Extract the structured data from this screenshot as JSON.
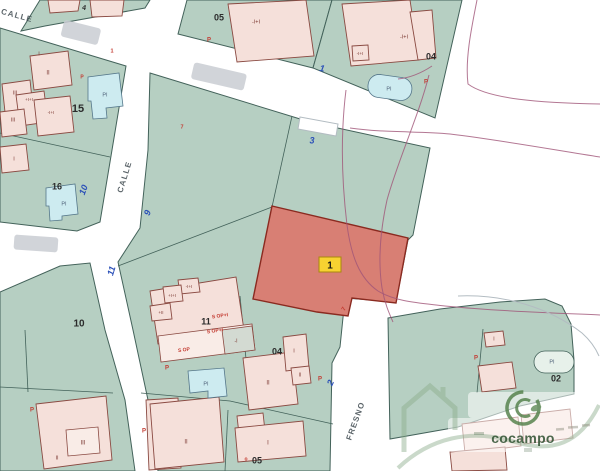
{
  "colors": {
    "green": "#b6cfc2",
    "line": "#43625a",
    "pink": "#f5e0da",
    "pinkline": "#8a4a42",
    "pool": "#cdebf0",
    "poolline": "#55778a",
    "red": "#d87f74",
    "redline": "#8a2a20",
    "yellow": "#f7d231",
    "blue": "#2b50b8",
    "purple": "#a05578",
    "casing": "#b3bcc2",
    "brand": "#4e7d45"
  },
  "highlight": {
    "parcel_label": "1"
  },
  "watermark": {
    "brand": "cocampo"
  },
  "labels": [
    {
      "id": "calle-top",
      "t": "CALLE",
      "x": 17,
      "y": 16,
      "r": 15,
      "c": "street"
    },
    {
      "id": "calle-west",
      "t": "CALLE",
      "x": 125,
      "y": 177,
      "r": -73,
      "c": "street"
    },
    {
      "id": "fresno",
      "t": "FRESNO",
      "x": 356,
      "y": 421,
      "r": -70,
      "c": "street"
    },
    {
      "id": "parcel-05-top",
      "t": "05",
      "x": 219,
      "y": 18,
      "c": "pnum"
    },
    {
      "id": "parcel-04-top",
      "t": "04",
      "x": 431,
      "y": 57,
      "c": "pnum"
    },
    {
      "id": "parcel-15",
      "t": "15",
      "x": 78,
      "y": 109,
      "c": "pnum",
      "s": 11
    },
    {
      "id": "parcel-16",
      "t": "16",
      "x": 57,
      "y": 187,
      "c": "pnum"
    },
    {
      "id": "parcel-10",
      "t": "10",
      "x": 79,
      "y": 324,
      "c": "pnum",
      "s": 10
    },
    {
      "id": "parcel-11",
      "t": "11",
      "x": 206,
      "y": 322,
      "c": "pnum"
    },
    {
      "id": "parcel-04-mid",
      "t": "04",
      "x": 277,
      "y": 352,
      "c": "pnum"
    },
    {
      "id": "parcel-05-bottom",
      "t": "05",
      "x": 257,
      "y": 461,
      "c": "pnum"
    },
    {
      "id": "parcel-02",
      "t": "02",
      "x": 556,
      "y": 379,
      "c": "pnum"
    },
    {
      "id": "housenum-4",
      "t": "4",
      "x": 84,
      "y": 8,
      "r": 12,
      "c": "pnum",
      "s": 7
    },
    {
      "id": "housenum-1",
      "t": "1",
      "x": 322,
      "y": 69,
      "r": 10,
      "c": "house"
    },
    {
      "id": "housenum-3",
      "t": "3",
      "x": 312,
      "y": 141,
      "c": "house"
    },
    {
      "id": "housenum-9",
      "t": "9",
      "x": 148,
      "y": 213,
      "r": -70,
      "c": "house"
    },
    {
      "id": "housenum-10",
      "t": "10",
      "x": 84,
      "y": 190,
      "r": -70,
      "c": "house"
    },
    {
      "id": "housenum-11",
      "t": "11",
      "x": 112,
      "y": 271,
      "r": -73,
      "c": "house"
    },
    {
      "id": "housenum-2",
      "t": "2",
      "x": 331,
      "y": 383,
      "r": -65,
      "c": "house"
    },
    {
      "id": "bldg-15-ii",
      "t": "II",
      "x": 48,
      "y": 73,
      "c": "bldg"
    },
    {
      "id": "bldg-15-iii-a",
      "t": "III",
      "x": 15,
      "y": 93,
      "c": "bldg",
      "s": 5.5
    },
    {
      "id": "bldg-15-plus",
      "t": "+I+I",
      "x": 29,
      "y": 100,
      "c": "bldg",
      "s": 4.5
    },
    {
      "id": "bldg-15-minus",
      "t": "-I+I",
      "x": 51,
      "y": 113,
      "c": "bldg",
      "s": 4.5
    },
    {
      "id": "bldg-15-iii-b",
      "t": "III",
      "x": 13,
      "y": 120,
      "c": "bldg",
      "s": 5.5
    },
    {
      "id": "bldg-15-i",
      "t": "I",
      "x": 39,
      "y": 54,
      "c": "bldg",
      "s": 5.5
    },
    {
      "id": "bldg-16-i",
      "t": "I",
      "x": 14,
      "y": 159,
      "c": "bldg",
      "s": 5.5
    },
    {
      "id": "bldg-05top",
      "t": "-I+I",
      "x": 256,
      "y": 22,
      "c": "bldg",
      "s": 5.5
    },
    {
      "id": "bldg-04top-a",
      "t": "-I+I",
      "x": 404,
      "y": 37,
      "c": "bldg",
      "s": 5.5
    },
    {
      "id": "bldg-04top-b",
      "t": "-I+I",
      "x": 360,
      "y": 54,
      "c": "bldg",
      "s": 4.5
    },
    {
      "id": "bldg-11-a",
      "t": "-I+I",
      "x": 189,
      "y": 287,
      "c": "bldg",
      "s": 4.5
    },
    {
      "id": "bldg-11-b",
      "t": "+I+I",
      "x": 172,
      "y": 296,
      "c": "bldg",
      "s": 4.5
    },
    {
      "id": "bldg-11-c",
      "t": "+II",
      "x": 161,
      "y": 313,
      "c": "bldg",
      "s": 4.5
    },
    {
      "id": "mark-sop-1",
      "t": "S OP+I",
      "x": 220,
      "y": 316,
      "r": -8,
      "c": "pmark",
      "s": 5
    },
    {
      "id": "mark-sop-2",
      "t": "S OP+I",
      "x": 215,
      "y": 331,
      "r": -8,
      "c": "pmark",
      "s": 5
    },
    {
      "id": "mark-sop-3",
      "t": "S OP",
      "x": 184,
      "y": 350,
      "r": -8,
      "c": "pmark",
      "s": 5
    },
    {
      "id": "bldg-11-gray",
      "t": "-I",
      "x": 236,
      "y": 341,
      "c": "bldg",
      "s": 5
    },
    {
      "id": "bldg-04mid-i",
      "t": "I",
      "x": 294,
      "y": 351,
      "c": "bldg",
      "s": 5.5
    },
    {
      "id": "bldg-04mid-ii",
      "t": "II",
      "x": 268,
      "y": 383,
      "c": "bldg"
    },
    {
      "id": "bldg-04mid-ii-s",
      "t": "II",
      "x": 300,
      "y": 375,
      "c": "bldg",
      "s": 5
    },
    {
      "id": "bldg-05bot-ii",
      "t": "II",
      "x": 186,
      "y": 442,
      "c": "bldg"
    },
    {
      "id": "bldg-05bot-i",
      "t": "I",
      "x": 268,
      "y": 443,
      "c": "bldg"
    },
    {
      "id": "bldg-10-iii",
      "t": "III",
      "x": 83,
      "y": 443,
      "c": "bldg"
    },
    {
      "id": "bldg-10-ii",
      "t": "II",
      "x": 57,
      "y": 458,
      "c": "bldg",
      "s": 5.5
    },
    {
      "id": "bldg-02-i",
      "t": "I",
      "x": 494,
      "y": 339,
      "c": "bldg",
      "s": 5
    },
    {
      "id": "pool-15",
      "t": "PI",
      "x": 105,
      "y": 95,
      "c": "pool"
    },
    {
      "id": "pool-16",
      "t": "PI",
      "x": 64,
      "y": 204,
      "c": "pool"
    },
    {
      "id": "pool-04",
      "t": "PI",
      "x": 389,
      "y": 89,
      "c": "pool"
    },
    {
      "id": "pool-11",
      "t": "PI",
      "x": 206,
      "y": 384,
      "c": "pool"
    },
    {
      "id": "pool-02",
      "t": "PI",
      "x": 552,
      "y": 362,
      "c": "pool"
    },
    {
      "id": "mark-p-1",
      "t": "P",
      "x": 209,
      "y": 40,
      "c": "pmark"
    },
    {
      "id": "mark-p-2",
      "t": "P",
      "x": 426,
      "y": 82,
      "c": "pmark"
    },
    {
      "id": "mark-p-3",
      "t": "P",
      "x": 167,
      "y": 368,
      "c": "pmark"
    },
    {
      "id": "mark-p-4",
      "t": "P",
      "x": 320,
      "y": 379,
      "c": "pmark"
    },
    {
      "id": "mark-p-5",
      "t": "P",
      "x": 32,
      "y": 410,
      "c": "pmark"
    },
    {
      "id": "mark-p-6",
      "t": "P",
      "x": 144,
      "y": 431,
      "c": "pmark"
    },
    {
      "id": "mark-p-7",
      "t": "P",
      "x": 476,
      "y": 358,
      "c": "pmark"
    },
    {
      "id": "mark-7-a",
      "t": "7",
      "x": 182,
      "y": 127,
      "c": "pmark",
      "s": 5.5
    },
    {
      "id": "mark-1-a",
      "t": "1",
      "x": 112,
      "y": 51,
      "c": "pmark",
      "s": 5.5
    },
    {
      "id": "mark-7-b",
      "t": "7",
      "x": 344,
      "y": 309,
      "r": -60,
      "c": "pmark"
    },
    {
      "id": "mark-p-8",
      "t": "P",
      "x": 82,
      "y": 77,
      "c": "pmark",
      "s": 5
    },
    {
      "id": "mark-o",
      "t": "o",
      "x": 246,
      "y": 459,
      "c": "pmark",
      "s": 5
    }
  ]
}
